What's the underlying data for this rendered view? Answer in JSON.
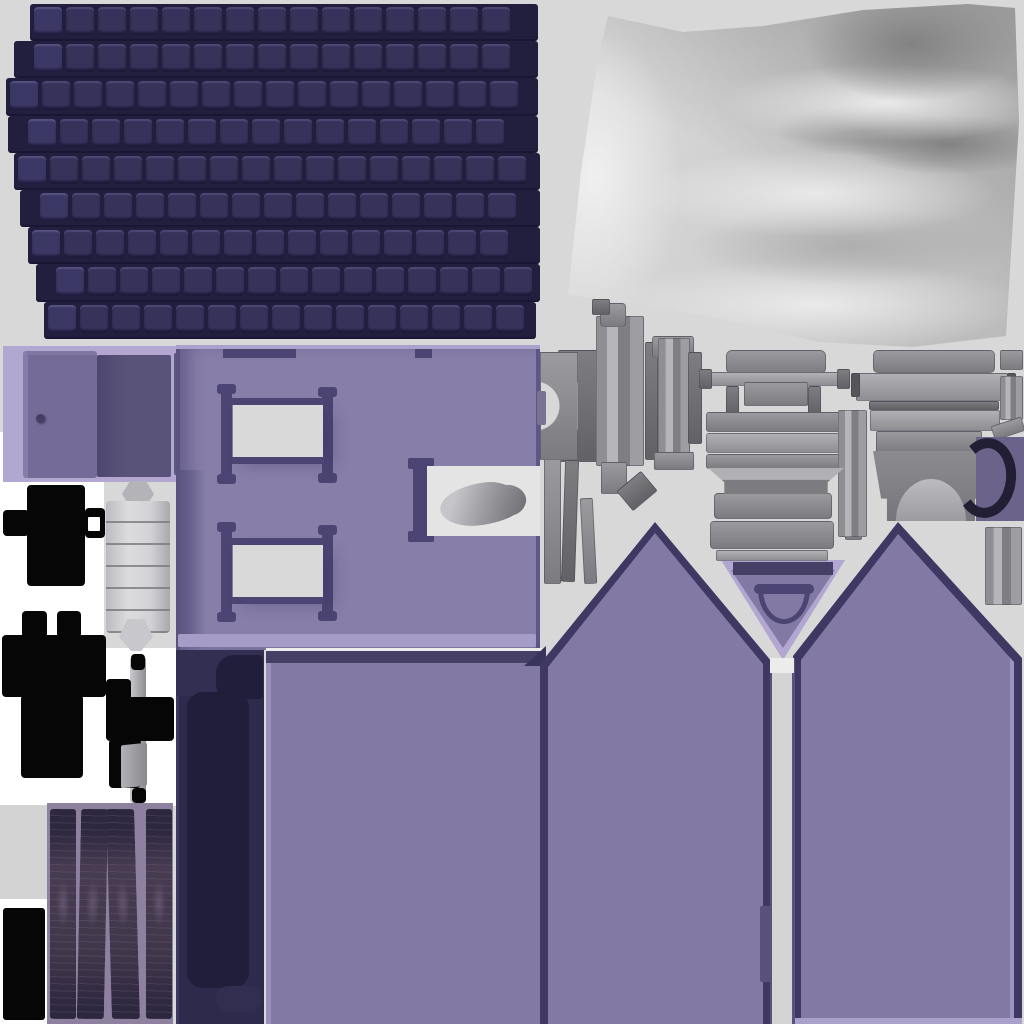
{
  "meta": {
    "kind": "3d-texture-atlas",
    "subject": "baked texture atlas sheet of a toy house model (roof shingles, walls, windows, doors, gables, cloth, furniture hardware)"
  },
  "canvas": {
    "width": 1024,
    "height": 1024,
    "background": "#d8d8d8"
  },
  "palette": {
    "bg": "#d8d8d8",
    "white": "#ffffff",
    "roof-tile": "#36325a",
    "roof-gap": "#211e3e",
    "roof-shadow": "#191634",
    "lavender": "#b1a7d0",
    "door": "#756b99",
    "door-dark": "#5a5379",
    "wall1": "#877ea9",
    "wall2": "#8279a4",
    "frame": "#4c4472",
    "trim": "#474066",
    "trim-d": "#3e3862",
    "pane": "#d9d9d9",
    "bed": "#2d2a4b",
    "bed-dark": "#211e3c",
    "black": "#060606",
    "wood-bg": "#8d819f",
    "arc-bg": "#6b6389",
    "arc": "#221e34",
    "gray-light": "#b1b1b5",
    "gray-mid": "#9b9b9f",
    "gray-dark": "#7e7e82"
  },
  "atlas_parts": [
    {
      "id": "roof-shingles",
      "label": "dark navy roof shingle sheet"
    },
    {
      "id": "satin-fabric",
      "label": "white satin cloth / curtain bake"
    },
    {
      "id": "door-panel",
      "label": "purple door panel with knob"
    },
    {
      "id": "front-wall",
      "label": "purple wall with two framed windows and one open pane"
    },
    {
      "id": "plain-wall",
      "label": "flat purple wall section"
    },
    {
      "id": "left-gable",
      "label": "left gable end wall"
    },
    {
      "id": "right-gable",
      "label": "right gable end wall"
    },
    {
      "id": "soffit-triangle",
      "label": "inverted eave triangle with arch window"
    },
    {
      "id": "bed-base",
      "label": "dark navy bed / base silhouette"
    },
    {
      "id": "wood-planks",
      "label": "four dark wood plank strips"
    },
    {
      "id": "hinge-cylinder",
      "label": "metal hinge barrel"
    },
    {
      "id": "black-shapes",
      "label": "solid black baked silhouettes"
    },
    {
      "id": "machine-parts",
      "label": "gray furniture / chimney hardware pieces"
    }
  ],
  "roof": {
    "x": 0,
    "y": 4,
    "row_height": 37.2,
    "tile_width": 28,
    "tile_gap": 4,
    "rows": [
      {
        "x": 30,
        "w": 508
      },
      {
        "x": 14,
        "w": 524
      },
      {
        "x": 6,
        "w": 532
      },
      {
        "x": 8,
        "w": 530
      },
      {
        "x": 14,
        "w": 526
      },
      {
        "x": 20,
        "w": 520
      },
      {
        "x": 28,
        "w": 512
      },
      {
        "x": 36,
        "w": 504
      },
      {
        "x": 44,
        "w": 492
      }
    ]
  },
  "wood": {
    "planks": [
      {
        "x": 3,
        "w": 26,
        "skew": 0
      },
      {
        "x": 32,
        "w": 27,
        "skew": -1.2
      },
      {
        "x": 62,
        "w": 28,
        "skew": 1.6
      },
      {
        "x": 99,
        "w": 26,
        "skew": 0
      }
    ]
  },
  "machine_parts": [
    {
      "x": 558,
      "y": 350,
      "w": 44,
      "h": 112,
      "tone": "dark"
    },
    {
      "x": 596,
      "y": 316,
      "w": 48,
      "h": 150,
      "tone": "light",
      "stripe": true
    },
    {
      "x": 600,
      "y": 303,
      "w": 26,
      "h": 24,
      "tone": "mid",
      "r": 4
    },
    {
      "x": 592,
      "y": 299,
      "w": 18,
      "h": 16,
      "tone": "dark"
    },
    {
      "x": 601,
      "y": 462,
      "w": 26,
      "h": 32,
      "tone": "mid"
    },
    {
      "x": 645,
      "y": 342,
      "w": 13,
      "h": 118,
      "tone": "dark"
    },
    {
      "x": 652,
      "y": 336,
      "w": 42,
      "h": 22,
      "tone": "mid",
      "r": 3
    },
    {
      "x": 658,
      "y": 338,
      "w": 32,
      "h": 132,
      "tone": "light",
      "stripe": true
    },
    {
      "x": 654,
      "y": 452,
      "w": 40,
      "h": 18,
      "tone": "mid"
    },
    {
      "x": 688,
      "y": 352,
      "w": 14,
      "h": 92,
      "tone": "dark"
    },
    {
      "x": 544,
      "y": 456,
      "w": 17,
      "h": 128,
      "tone": "mid"
    },
    {
      "x": 563,
      "y": 460,
      "w": 14,
      "h": 122,
      "tone": "dark",
      "rot": 2
    },
    {
      "x": 582,
      "y": 498,
      "w": 13,
      "h": 86,
      "tone": "mid",
      "rot": -3
    },
    {
      "x": 621,
      "y": 478,
      "w": 32,
      "h": 26,
      "tone": "dark",
      "rot": -40
    },
    {
      "x": 726,
      "y": 350,
      "w": 100,
      "h": 24,
      "tone": "mid",
      "r": 6
    },
    {
      "x": 704,
      "y": 372,
      "w": 146,
      "h": 14,
      "tone": "light"
    },
    {
      "x": 699,
      "y": 369,
      "w": 13,
      "h": 20,
      "tone": "dark"
    },
    {
      "x": 837,
      "y": 369,
      "w": 13,
      "h": 20,
      "tone": "dark"
    },
    {
      "x": 726,
      "y": 386,
      "w": 13,
      "h": 30,
      "tone": "dark"
    },
    {
      "x": 808,
      "y": 386,
      "w": 13,
      "h": 30,
      "tone": "dark"
    },
    {
      "x": 744,
      "y": 382,
      "w": 64,
      "h": 24,
      "tone": "mid"
    },
    {
      "x": 706,
      "y": 412,
      "w": 136,
      "h": 20,
      "tone": "mid",
      "r": 3
    },
    {
      "x": 706,
      "y": 433,
      "w": 136,
      "h": 20,
      "tone": "light",
      "r": 3
    },
    {
      "x": 706,
      "y": 454,
      "w": 136,
      "h": 15,
      "tone": "mid",
      "r": 3
    },
    {
      "x": 714,
      "y": 493,
      "w": 118,
      "h": 26,
      "tone": "mid",
      "r": 4
    },
    {
      "x": 710,
      "y": 521,
      "w": 124,
      "h": 28,
      "tone": "mid",
      "r": 4
    },
    {
      "x": 716,
      "y": 550,
      "w": 112,
      "h": 11,
      "tone": "light"
    },
    {
      "x": 845,
      "y": 510,
      "w": 17,
      "h": 30,
      "tone": "mid"
    },
    {
      "x": 838,
      "y": 410,
      "w": 29,
      "h": 127,
      "tone": "light",
      "stripe": true
    },
    {
      "x": 873,
      "y": 350,
      "w": 122,
      "h": 23,
      "tone": "mid",
      "r": 5
    },
    {
      "x": 856,
      "y": 373,
      "w": 152,
      "h": 28,
      "tone": "light"
    },
    {
      "x": 851,
      "y": 373,
      "w": 9,
      "h": 24,
      "tone": "darker"
    },
    {
      "x": 1007,
      "y": 373,
      "w": 9,
      "h": 24,
      "tone": "darker"
    },
    {
      "x": 869,
      "y": 401,
      "w": 130,
      "h": 9,
      "tone": "dark"
    },
    {
      "x": 870,
      "y": 410,
      "w": 130,
      "h": 21,
      "tone": "light"
    },
    {
      "x": 876,
      "y": 431,
      "w": 106,
      "h": 22,
      "tone": "mid"
    },
    {
      "x": 891,
      "y": 489,
      "w": 82,
      "h": 13,
      "tone": "dark"
    },
    {
      "x": 894,
      "y": 502,
      "w": 76,
      "h": 17,
      "tone": "mid"
    },
    {
      "x": 1000,
      "y": 350,
      "w": 23,
      "h": 20,
      "tone": "mid"
    },
    {
      "x": 1000,
      "y": 376,
      "w": 23,
      "h": 44,
      "tone": "light",
      "stripe": true
    },
    {
      "x": 992,
      "y": 421,
      "w": 32,
      "h": 15,
      "tone": "mid",
      "rot": -18
    },
    {
      "x": 985,
      "y": 527,
      "w": 37,
      "h": 78,
      "tone": "mid",
      "stripe": true
    }
  ]
}
